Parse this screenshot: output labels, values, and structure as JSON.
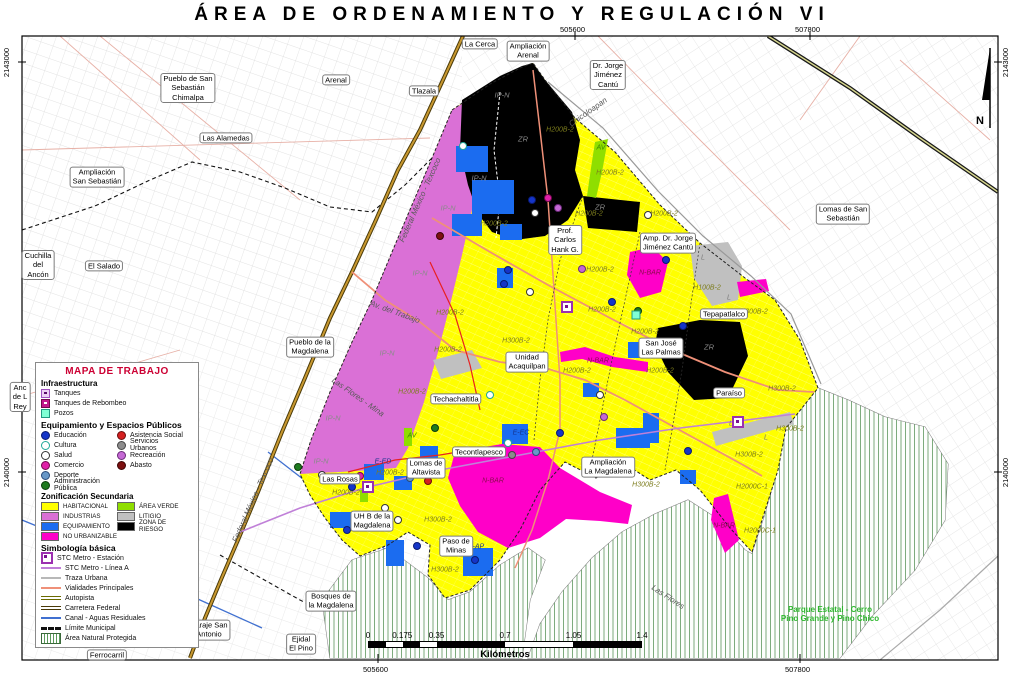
{
  "title": "ÁREA DE ORDENAMIENTO Y REGULACIÓN VI",
  "frame": {
    "north_label": "N",
    "coords_top": [
      "505600",
      "507800"
    ],
    "coords_bottom": [
      "505600",
      "507800"
    ],
    "coords_left": [
      "2143000",
      "2140000"
    ],
    "coords_right": [
      "2143000",
      "2140000"
    ]
  },
  "legend": {
    "title": "MAPA DE TRABAJO",
    "infraestructura": {
      "heading": "Infraestructura",
      "items": [
        "Tanques",
        "Tanques de Rebombeo",
        "Pozos"
      ]
    },
    "equipamiento": {
      "heading": "Equipamiento y Espacios Públicos",
      "col1": [
        "Educación",
        "Cultura",
        "Salud",
        "Comercio",
        "Deporte",
        "Administración Pública"
      ],
      "col2": [
        "Asistencia Social",
        "Servicios Urbanos",
        "Recreación",
        "Abasto"
      ]
    },
    "zonificacion": {
      "heading": "Zonificación Secundaria",
      "col1": [
        "HABITACIONAL",
        "INDUSTRIAS",
        "EQUIPAMIENTO",
        "NO URBANIZABLE"
      ],
      "col2": [
        "ÁREA VERDE",
        "LITIGIO",
        "ZONA DE RIESGO"
      ]
    },
    "simbologia": {
      "heading": "Simbología básica",
      "items": [
        "STC Metro - Estación",
        "STC Metro - Línea A",
        "Traza Urbana",
        "Vialidades Principales",
        "Autopista",
        "Carretera Federal",
        "Canal - Aguas Residuales",
        "Límite Municipal",
        "Área Natural Protegida"
      ]
    }
  },
  "scalebar": {
    "ticks": [
      "0",
      "0.175",
      "0.35",
      "0.7",
      "1.05",
      "1.4"
    ],
    "unit": "Kilómetros"
  },
  "map": {
    "place_labels": [
      {
        "text": "La Cerca",
        "x": 480,
        "y": 44
      },
      {
        "text": "Ampliación\nArenal",
        "x": 528,
        "y": 51
      },
      {
        "text": "Dr. Jorge\nJiménez\nCantú",
        "x": 608,
        "y": 75
      },
      {
        "text": "Pueblo de San\nSebastián\nChimalpa",
        "x": 188,
        "y": 88
      },
      {
        "text": "Arenal",
        "x": 336,
        "y": 80
      },
      {
        "text": "Tlazala",
        "x": 424,
        "y": 91
      },
      {
        "text": "Las Alamedas",
        "x": 226,
        "y": 138
      },
      {
        "text": "Ampliación\nSan Sebastián",
        "x": 97,
        "y": 177
      },
      {
        "text": "Lomas de San\nSebastián",
        "x": 843,
        "y": 214
      },
      {
        "text": "Cuchilla\ndel\nAncón",
        "x": 38,
        "y": 265
      },
      {
        "text": "El Salado",
        "x": 104,
        "y": 266
      },
      {
        "text": "Prof.\nCarlos\nHank G.",
        "x": 565,
        "y": 240
      },
      {
        "text": "Amp. Dr. Jorge\nJiménez Cantú",
        "x": 668,
        "y": 243
      },
      {
        "text": "Tepapatlalco",
        "x": 724,
        "y": 314
      },
      {
        "text": "San José\nLas Palmas",
        "x": 661,
        "y": 348
      },
      {
        "text": "Paraíso",
        "x": 729,
        "y": 393
      },
      {
        "text": "Pueblo de la\nMagdalena",
        "x": 310,
        "y": 347
      },
      {
        "text": "Unidad\nAcaquilpan",
        "x": 527,
        "y": 362
      },
      {
        "text": "Techachaltitla",
        "x": 456,
        "y": 399
      },
      {
        "text": "Tecontlapesco",
        "x": 479,
        "y": 452
      },
      {
        "text": "Lomas de\nAltavista",
        "x": 426,
        "y": 468
      },
      {
        "text": "Ampliación\nLa Magdalena",
        "x": 608,
        "y": 467
      },
      {
        "text": "Las Rosas",
        "x": 340,
        "y": 479
      },
      {
        "text": "UH B de la\nMagdalena",
        "x": 372,
        "y": 521
      },
      {
        "text": "Paso de\nMinas",
        "x": 456,
        "y": 546
      },
      {
        "text": "Bosques de\nla Magdalena",
        "x": 331,
        "y": 601
      },
      {
        "text": "Paraje San\nAntonio",
        "x": 209,
        "y": 630
      },
      {
        "text": "Ejidal\nEl Pino",
        "x": 301,
        "y": 644
      },
      {
        "text": "Ferrocarril",
        "x": 107,
        "y": 655
      },
      {
        "text": "Anc\nde L\nRey",
        "x": 20,
        "y": 397,
        "clip": true
      }
    ],
    "road_labels": [
      {
        "text": "Chicoloapan",
        "x": 588,
        "y": 112,
        "rot": -35
      },
      {
        "text": "Federal México - Texcoco",
        "x": 420,
        "y": 200,
        "rot": -66
      },
      {
        "text": "Federal México - Texcoco",
        "x": 253,
        "y": 500,
        "rot": -66
      },
      {
        "text": "Av. del Trabajo",
        "x": 395,
        "y": 312,
        "rot": 20
      },
      {
        "text": "Las Flores - Mina",
        "x": 358,
        "y": 397,
        "rot": 35
      },
      {
        "text": "Las Flores",
        "x": 668,
        "y": 597,
        "rot": 33
      }
    ],
    "zone_codes": [
      {
        "text": "IP-N",
        "cls": "g",
        "x": 502,
        "y": 95
      },
      {
        "text": "IP-N",
        "cls": "g",
        "x": 479,
        "y": 178
      },
      {
        "text": "IP-N",
        "cls": "g",
        "x": 448,
        "y": 208
      },
      {
        "text": "IP-N",
        "cls": "g",
        "x": 420,
        "y": 273
      },
      {
        "text": "IP-N",
        "cls": "g",
        "x": 387,
        "y": 353
      },
      {
        "text": "IP-N",
        "cls": "g",
        "x": 333,
        "y": 418
      },
      {
        "text": "IP-N",
        "cls": "g",
        "x": 321,
        "y": 461
      },
      {
        "text": "ZR",
        "cls": "g",
        "x": 523,
        "y": 139
      },
      {
        "text": "ZR",
        "cls": "g",
        "x": 600,
        "y": 207
      },
      {
        "text": "ZR",
        "cls": "g",
        "x": 709,
        "y": 347
      },
      {
        "text": "H200B-2",
        "cls": "o",
        "x": 560,
        "y": 130
      },
      {
        "text": "H200B-2",
        "cls": "o",
        "x": 610,
        "y": 173
      },
      {
        "text": "H200B-2",
        "cls": "o",
        "x": 664,
        "y": 214
      },
      {
        "text": "H200B-2",
        "cls": "o",
        "x": 589,
        "y": 214
      },
      {
        "text": "H200B-2",
        "cls": "o",
        "x": 494,
        "y": 224
      },
      {
        "text": "H200B-2",
        "cls": "o",
        "x": 600,
        "y": 270
      },
      {
        "text": "H200B-2",
        "cls": "o",
        "x": 602,
        "y": 310
      },
      {
        "text": "H200B-2",
        "cls": "o",
        "x": 645,
        "y": 332
      },
      {
        "text": "H200B-2",
        "cls": "o",
        "x": 577,
        "y": 371
      },
      {
        "text": "H200B-2",
        "cls": "o",
        "x": 660,
        "y": 371
      },
      {
        "text": "H200B-2",
        "cls": "o",
        "x": 450,
        "y": 313
      },
      {
        "text": "H200B-2",
        "cls": "o",
        "x": 448,
        "y": 350
      },
      {
        "text": "H200B-2",
        "cls": "o",
        "x": 412,
        "y": 392
      },
      {
        "text": "H200B-2",
        "cls": "o",
        "x": 390,
        "y": 473
      },
      {
        "text": "H200B-2",
        "cls": "o",
        "x": 346,
        "y": 493
      },
      {
        "text": "H100B-2",
        "cls": "o",
        "x": 707,
        "y": 288
      },
      {
        "text": "H300B-2",
        "cls": "o",
        "x": 516,
        "y": 341
      },
      {
        "text": "H300B-2",
        "cls": "o",
        "x": 754,
        "y": 312
      },
      {
        "text": "H300B-2",
        "cls": "o",
        "x": 782,
        "y": 389
      },
      {
        "text": "H300B-2",
        "cls": "o",
        "x": 790,
        "y": 429
      },
      {
        "text": "H300B-2",
        "cls": "o",
        "x": 749,
        "y": 455
      },
      {
        "text": "H300B-2",
        "cls": "o",
        "x": 646,
        "y": 485
      },
      {
        "text": "H300B-2",
        "cls": "o",
        "x": 438,
        "y": 520
      },
      {
        "text": "H300B-2",
        "cls": "o",
        "x": 445,
        "y": 570
      },
      {
        "text": "H2000C-1",
        "cls": "o",
        "x": 752,
        "y": 487
      },
      {
        "text": "H2000C-1",
        "cls": "o",
        "x": 760,
        "y": 531
      },
      {
        "text": "N-BAR",
        "cls": "m",
        "x": 650,
        "y": 273
      },
      {
        "text": "N-BAR",
        "cls": "m",
        "x": 598,
        "y": 361
      },
      {
        "text": "N-BAR",
        "cls": "m",
        "x": 493,
        "y": 481
      },
      {
        "text": "N-BAR",
        "cls": "m",
        "x": 724,
        "y": 526
      },
      {
        "text": "L",
        "cls": "l",
        "x": 703,
        "y": 258
      },
      {
        "text": "L",
        "cls": "l",
        "x": 729,
        "y": 298
      },
      {
        "text": "L",
        "cls": "l",
        "x": 731,
        "y": 424
      },
      {
        "text": "L",
        "cls": "l",
        "x": 766,
        "y": 438
      },
      {
        "text": "AV",
        "cls": "gr",
        "x": 601,
        "y": 148
      },
      {
        "text": "AV",
        "cls": "gr",
        "x": 412,
        "y": 436
      },
      {
        "text": "E-EC",
        "cls": "b",
        "x": 521,
        "y": 433
      },
      {
        "text": "E-ED",
        "cls": "b",
        "x": 383,
        "y": 462
      },
      {
        "text": "E-AP",
        "cls": "b",
        "x": 476,
        "y": 547
      }
    ],
    "park_label": {
      "text": "Parque Estatal - Cerro\nPino Grande y Pino Chico",
      "x": 830,
      "y": 614
    },
    "points": [
      {
        "t": "cultura",
        "x": 463,
        "y": 146
      },
      {
        "t": "educacion",
        "x": 532,
        "y": 200
      },
      {
        "t": "comercio",
        "x": 548,
        "y": 198
      },
      {
        "t": "salud",
        "x": 535,
        "y": 213
      },
      {
        "t": "recreacion",
        "x": 558,
        "y": 208
      },
      {
        "t": "abasto",
        "x": 440,
        "y": 236
      },
      {
        "t": "salud",
        "x": 648,
        "y": 215
      },
      {
        "t": "salud",
        "x": 681,
        "y": 246
      },
      {
        "t": "educacion",
        "x": 666,
        "y": 260
      },
      {
        "t": "recreacion",
        "x": 582,
        "y": 269
      },
      {
        "t": "educacion",
        "x": 508,
        "y": 270
      },
      {
        "t": "educacion",
        "x": 504,
        "y": 284
      },
      {
        "t": "salud",
        "x": 530,
        "y": 292
      },
      {
        "t": "educacion",
        "x": 612,
        "y": 302
      },
      {
        "t": "administracion",
        "x": 638,
        "y": 311
      },
      {
        "t": "educacion",
        "x": 683,
        "y": 326
      },
      {
        "t": "salud",
        "x": 600,
        "y": 395
      },
      {
        "t": "recreacion",
        "x": 604,
        "y": 417
      },
      {
        "t": "administracion",
        "x": 435,
        "y": 428
      },
      {
        "t": "cultura",
        "x": 508,
        "y": 443
      },
      {
        "t": "deporte",
        "x": 536,
        "y": 452
      },
      {
        "t": "educacion",
        "x": 560,
        "y": 433
      },
      {
        "t": "educacion",
        "x": 352,
        "y": 487
      },
      {
        "t": "salud",
        "x": 322,
        "y": 475
      },
      {
        "t": "comercio",
        "x": 360,
        "y": 476
      },
      {
        "t": "deporte",
        "x": 410,
        "y": 478
      },
      {
        "t": "salud",
        "x": 385,
        "y": 508
      },
      {
        "t": "salud",
        "x": 398,
        "y": 520
      },
      {
        "t": "educacion",
        "x": 347,
        "y": 530
      },
      {
        "t": "educacion",
        "x": 417,
        "y": 546
      },
      {
        "t": "educacion",
        "x": 475,
        "y": 560
      },
      {
        "t": "asistencia",
        "x": 428,
        "y": 481
      },
      {
        "t": "abasto",
        "x": 420,
        "y": 470
      },
      {
        "t": "educacion",
        "x": 688,
        "y": 451
      },
      {
        "t": "cultura",
        "x": 490,
        "y": 395
      },
      {
        "t": "administracion",
        "x": 298,
        "y": 467
      },
      {
        "t": "servicios",
        "x": 512,
        "y": 455
      }
    ],
    "stations": [
      {
        "x": 368,
        "y": 487
      },
      {
        "x": 567,
        "y": 307
      },
      {
        "x": 738,
        "y": 422
      }
    ],
    "pozos": [
      {
        "x": 636,
        "y": 315
      }
    ]
  },
  "colors": {
    "zones": {
      "habitacional": "#ffff00",
      "industrias": "#da70d6",
      "equipamiento": "#1b6cf0",
      "no_urbanizable": "#ff00c8",
      "area_verde": "#8fde00",
      "litigio": "#c0c0c0",
      "zona_de_riesgo": "#000000"
    },
    "points": {
      "educacion": {
        "fill": "#1535c8",
        "border": "#0a1a70"
      },
      "cultura": {
        "fill": "#ffffff",
        "border": "#20a898"
      },
      "salud": {
        "fill": "#ffffff",
        "border": "#333333"
      },
      "comercio": {
        "fill": "#e020a8",
        "border": "#70084c"
      },
      "deporte": {
        "fill": "#6898c8",
        "border": "#2a4a78"
      },
      "administracion": {
        "fill": "#1e7a1e",
        "border": "#0c3c0c"
      },
      "asistencia": {
        "fill": "#d42020",
        "border": "#6a0c0c"
      },
      "servicios": {
        "fill": "#8c8c8c",
        "border": "#444444"
      },
      "recreacion": {
        "fill": "#c468d4",
        "border": "#6a2a78"
      },
      "abasto": {
        "fill": "#7c1010",
        "border": "#3a0404"
      }
    },
    "lines": {
      "metro_linea_a": "#c080d8",
      "vialidades": "#ef9078",
      "carretera_federal": "#4a3a08",
      "canal": "#4070d0",
      "anp_hatch": "#5a9a5a",
      "legend_title": "#cc0033",
      "park_text": "#2db82d"
    }
  }
}
